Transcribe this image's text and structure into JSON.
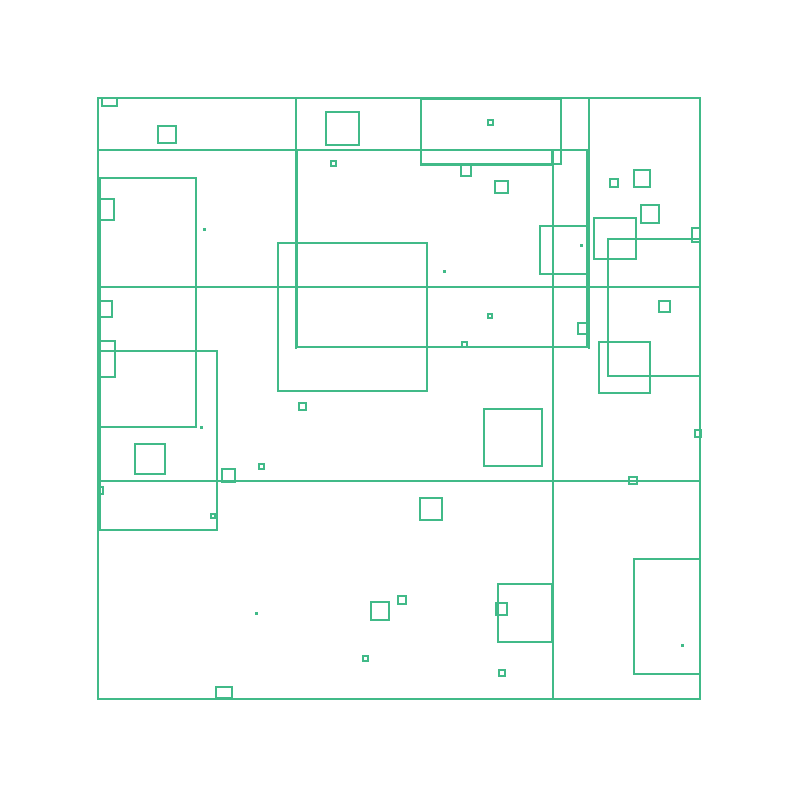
{
  "canvas": {
    "background": "#ffffff",
    "stroke_color": "#41ba88",
    "stroke_width": 2,
    "frame": {
      "x": 97,
      "y": 97,
      "w": 604,
      "h": 603
    },
    "lines": [
      {
        "x": 98,
        "y": 149,
        "w": 492,
        "h": 2
      },
      {
        "x": 97,
        "y": 286,
        "w": 604,
        "h": 2
      },
      {
        "x": 97,
        "y": 480,
        "w": 604,
        "h": 2
      },
      {
        "x": 295,
        "y": 97,
        "w": 2,
        "h": 252
      },
      {
        "x": 552,
        "y": 149,
        "w": 2,
        "h": 551
      },
      {
        "x": 588,
        "y": 97,
        "w": 2,
        "h": 252
      }
    ],
    "rects": [
      {
        "x": 101,
        "y": 97,
        "w": 17,
        "h": 10
      },
      {
        "x": 157,
        "y": 125,
        "w": 20,
        "h": 19
      },
      {
        "x": 325,
        "y": 111,
        "w": 35,
        "h": 35
      },
      {
        "x": 420,
        "y": 98,
        "w": 142,
        "h": 67
      },
      {
        "x": 420,
        "y": 149,
        "w": 133,
        "h": 17
      },
      {
        "x": 460,
        "y": 164,
        "w": 12,
        "h": 13
      },
      {
        "x": 487,
        "y": 119,
        "w": 7,
        "h": 7
      },
      {
        "x": 494,
        "y": 180,
        "w": 15,
        "h": 14
      },
      {
        "x": 330,
        "y": 160,
        "w": 7,
        "h": 7
      },
      {
        "x": 99,
        "y": 177,
        "w": 98,
        "h": 251
      },
      {
        "x": 99,
        "y": 198,
        "w": 16,
        "h": 23
      },
      {
        "x": 99,
        "y": 300,
        "w": 14,
        "h": 18
      },
      {
        "x": 99,
        "y": 340,
        "w": 17,
        "h": 38
      },
      {
        "x": 99,
        "y": 350,
        "w": 119,
        "h": 181
      },
      {
        "x": 296,
        "y": 149,
        "w": 292,
        "h": 199
      },
      {
        "x": 277,
        "y": 242,
        "w": 151,
        "h": 150
      },
      {
        "x": 539,
        "y": 225,
        "w": 49,
        "h": 50
      },
      {
        "x": 593,
        "y": 217,
        "w": 44,
        "h": 43
      },
      {
        "x": 607,
        "y": 238,
        "w": 94,
        "h": 139
      },
      {
        "x": 609,
        "y": 178,
        "w": 10,
        "h": 10
      },
      {
        "x": 633,
        "y": 169,
        "w": 18,
        "h": 19
      },
      {
        "x": 640,
        "y": 204,
        "w": 20,
        "h": 20
      },
      {
        "x": 691,
        "y": 227,
        "w": 10,
        "h": 16
      },
      {
        "x": 658,
        "y": 300,
        "w": 13,
        "h": 13
      },
      {
        "x": 577,
        "y": 322,
        "w": 13,
        "h": 13
      },
      {
        "x": 598,
        "y": 341,
        "w": 53,
        "h": 53
      },
      {
        "x": 487,
        "y": 313,
        "w": 6,
        "h": 6
      },
      {
        "x": 461,
        "y": 341,
        "w": 7,
        "h": 7
      },
      {
        "x": 298,
        "y": 402,
        "w": 9,
        "h": 9
      },
      {
        "x": 134,
        "y": 443,
        "w": 32,
        "h": 32
      },
      {
        "x": 221,
        "y": 468,
        "w": 15,
        "h": 15
      },
      {
        "x": 258,
        "y": 463,
        "w": 7,
        "h": 7
      },
      {
        "x": 97,
        "y": 486,
        "w": 7,
        "h": 9
      },
      {
        "x": 210,
        "y": 513,
        "w": 6,
        "h": 6
      },
      {
        "x": 628,
        "y": 476,
        "w": 10,
        "h": 9
      },
      {
        "x": 694,
        "y": 429,
        "w": 8,
        "h": 9
      },
      {
        "x": 483,
        "y": 408,
        "w": 60,
        "h": 59
      },
      {
        "x": 419,
        "y": 497,
        "w": 24,
        "h": 24
      },
      {
        "x": 370,
        "y": 601,
        "w": 20,
        "h": 20
      },
      {
        "x": 397,
        "y": 595,
        "w": 10,
        "h": 10
      },
      {
        "x": 362,
        "y": 655,
        "w": 7,
        "h": 7
      },
      {
        "x": 497,
        "y": 583,
        "w": 56,
        "h": 60
      },
      {
        "x": 495,
        "y": 602,
        "w": 13,
        "h": 14
      },
      {
        "x": 498,
        "y": 669,
        "w": 8,
        "h": 8
      },
      {
        "x": 215,
        "y": 686,
        "w": 18,
        "h": 13
      },
      {
        "x": 633,
        "y": 558,
        "w": 68,
        "h": 117
      }
    ],
    "dots": [
      {
        "x": 203,
        "y": 228,
        "s": 3
      },
      {
        "x": 443,
        "y": 270,
        "s": 3
      },
      {
        "x": 580,
        "y": 244,
        "s": 3
      },
      {
        "x": 200,
        "y": 426,
        "s": 3
      },
      {
        "x": 255,
        "y": 612,
        "s": 3
      },
      {
        "x": 681,
        "y": 644,
        "s": 3
      }
    ]
  }
}
